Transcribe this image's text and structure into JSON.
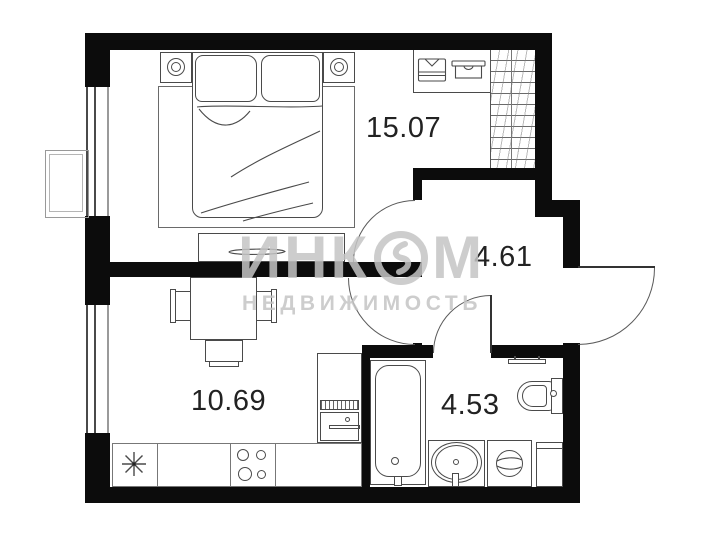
{
  "watermark": {
    "prefix": "ИНК",
    "suffix": "М",
    "line2": "НЕДВИЖИМОСТЬ"
  },
  "rooms": {
    "bedroom": {
      "area_m2": "15.07"
    },
    "hallway": {
      "area_m2": "4.61"
    },
    "kitchen_living": {
      "area_m2": "10.69"
    },
    "bathroom": {
      "area_m2": "4.53"
    }
  },
  "icons": {
    "incom-logo-icon": "ring-with-bolt",
    "kitchen-sink-icon": "asterisk-star",
    "stove-icon": "four-burner-circles",
    "wardrobe-shirt-icon": "folded-shirt",
    "wardrobe-box-icon": "storage-box"
  },
  "colors": {
    "wall": "#0c0c0c",
    "furniture_line": "#4a4a4a",
    "background": "#ffffff",
    "watermark": "#c4c4c4"
  }
}
